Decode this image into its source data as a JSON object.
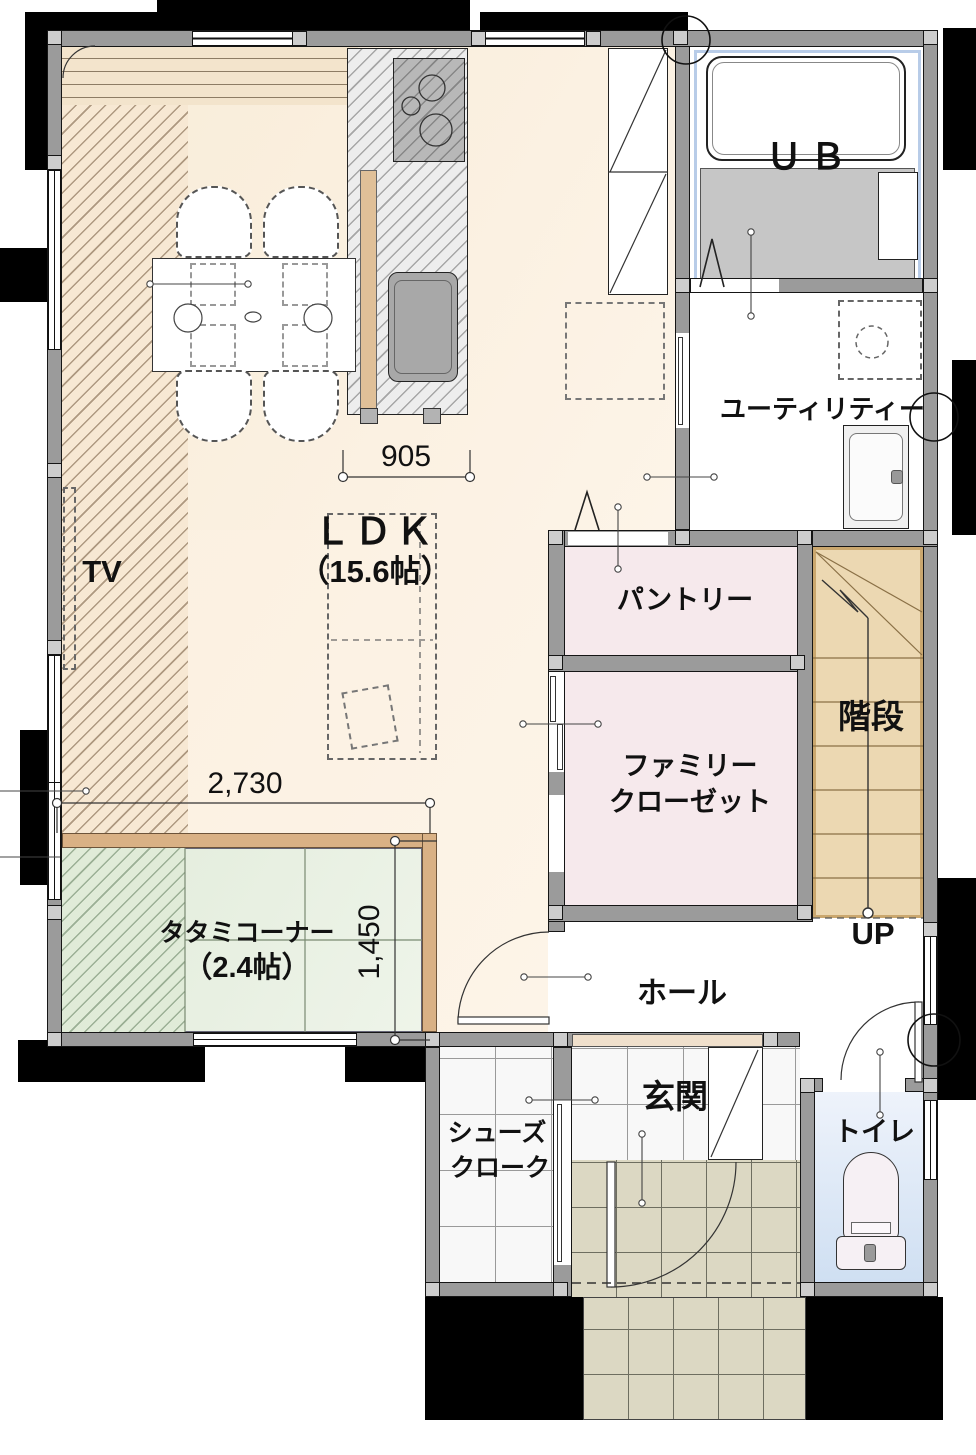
{
  "rooms": {
    "ldk": {
      "label": "ＬＤＫ",
      "size": "（15.6帖）"
    },
    "tatami_corner": {
      "label": "タタミコーナー",
      "size": "（2.4帖）"
    },
    "pantry": {
      "label": "パントリー"
    },
    "family_closet": {
      "line1": "ファミリー",
      "line2": "クローゼット"
    },
    "stairs": {
      "label": "階段",
      "direction": "UP"
    },
    "hall": {
      "label": "ホール"
    },
    "entrance": {
      "label": "玄関"
    },
    "shoes_cloak": {
      "line1": "シューズ",
      "line2": "クローク"
    },
    "toilet": {
      "label": "トイレ"
    },
    "utility": {
      "label": "ユーティリティー"
    },
    "unit_bath": {
      "label": "ＵＢ"
    },
    "tv_board": {
      "label": "TV"
    }
  },
  "dimensions": {
    "kitchen_counter": "905",
    "tatami_width": "2,730",
    "tatami_depth": "1,450"
  },
  "colors": {
    "ldk_floor": "#fdf3e6",
    "flooring_accent": "#f7e8d3",
    "tatami": "#eaf1e3",
    "service_room": "#f6e9ec",
    "stairs": "#ecd8b2",
    "wood_trim": "#d9b185",
    "tile": "#dcd8c3",
    "toilet_floor": "#dfe9f6",
    "wall": "#9b9b9b"
  }
}
